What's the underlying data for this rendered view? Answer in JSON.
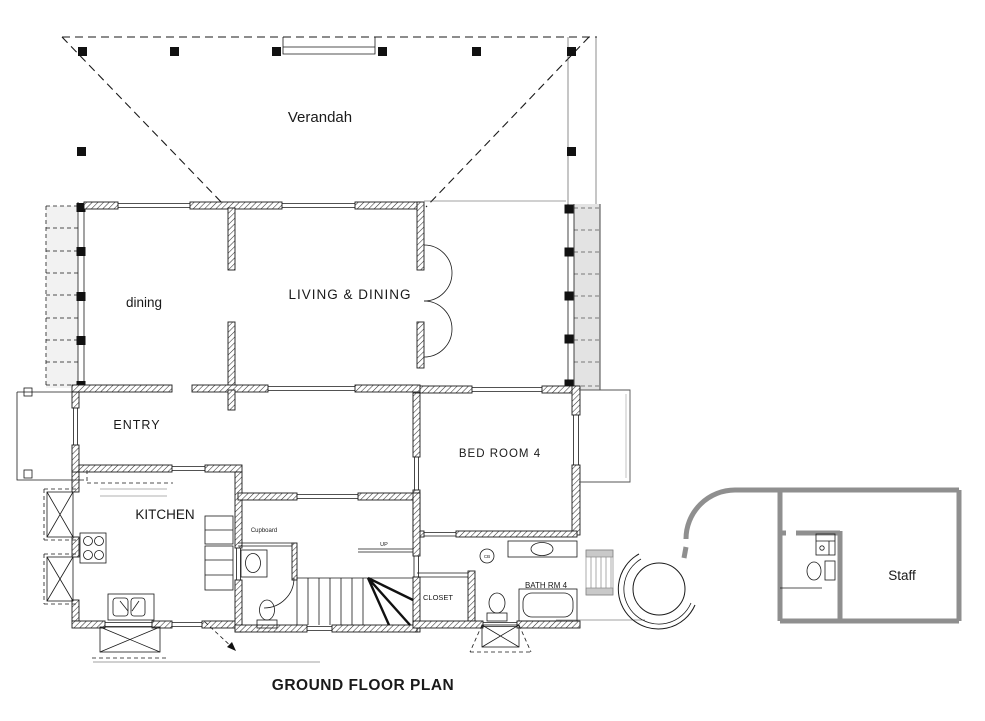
{
  "title": "GROUND FLOOR PLAN",
  "rooms": {
    "verandah": "Verandah",
    "dining": "dining",
    "living_dining": "LIVING & DINING",
    "entry": "ENTRY",
    "kitchen": "KITCHEN",
    "bedroom4": "BED ROOM 4",
    "closet": "CLOSET",
    "bathrm4": "BATH RM 4",
    "cupboard": "Cupboard",
    "staff": "Staff"
  },
  "annotations": {
    "up": "UP",
    "cb": "CB"
  },
  "colors": {
    "ink": "#1a1a1a",
    "wall_gray": "#8f8f8f",
    "paper": "#ffffff",
    "louver_band": "#e3e3e3"
  }
}
